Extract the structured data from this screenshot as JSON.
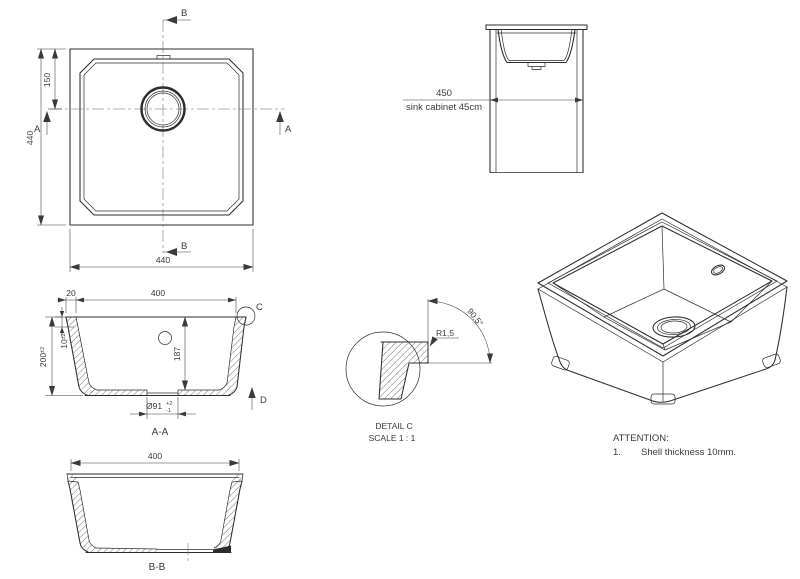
{
  "drawing": {
    "top_view": {
      "marker_b": "B",
      "marker_a": "A",
      "dim_height": "440",
      "dim_drain_from_top": "150",
      "dim_width": "440"
    },
    "cabinet_view": {
      "dim_width": "450",
      "label": "sink cabinet 45cm"
    },
    "section_aa": {
      "dim_rim_width": "20",
      "dim_opening": "400",
      "dim_shell": "10",
      "dim_shell_tol": "±2",
      "dim_height": "200",
      "dim_height_tol": "±2",
      "dim_depth": "187",
      "dim_drain_dia": "Ø91",
      "dim_drain_tol_plus": "+2",
      "dim_drain_tol_minus": "-1",
      "marker_c": "C",
      "marker_d": "D",
      "label": "A-A"
    },
    "detail_c": {
      "dim_angle": "90.5°",
      "dim_radius": "R1,5",
      "title": "DETAIL C",
      "scale": "SCALE 1 : 1"
    },
    "section_bb": {
      "dim_opening": "400",
      "label": "B-B"
    },
    "notes": {
      "title": "ATTENTION:",
      "item1_num": "1.",
      "item1_text": "Shell thickness 10mm."
    }
  }
}
